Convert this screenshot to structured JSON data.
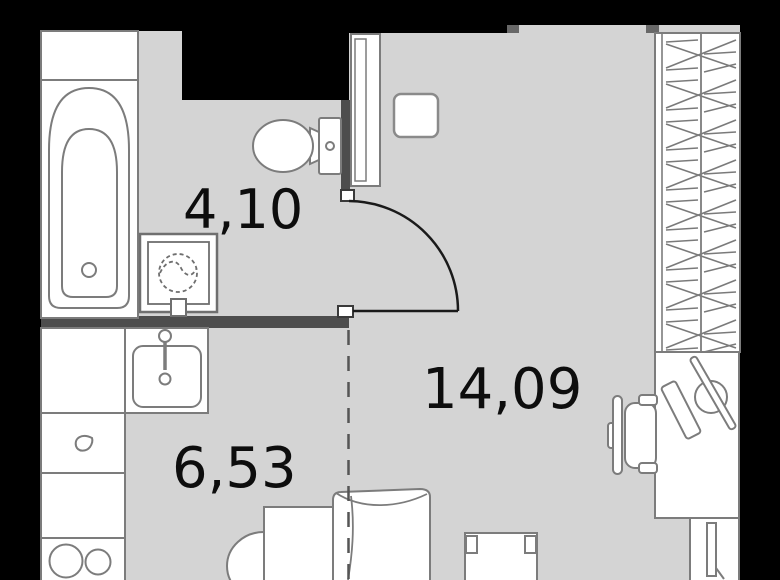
{
  "floor_plan": {
    "type": "studio-apartment-floor-plan",
    "labels": {
      "bathroom_area": "4,10",
      "kitchen_area": "6,53",
      "living_area": "14,09"
    },
    "rooms": [
      {
        "id": "bathroom",
        "area_sqm": "4,10"
      },
      {
        "id": "kitchen",
        "area_sqm": "6,53"
      },
      {
        "id": "living-room",
        "area_sqm": "14,09"
      }
    ],
    "furniture": [
      "bathtub",
      "washing-machine",
      "toilet",
      "hall-stool",
      "entry-door",
      "wardrobe",
      "desk",
      "desk-chair",
      "kitchen-counter",
      "kitchen-sink",
      "stove",
      "bed",
      "bed-table",
      "armchair",
      "tv-bench",
      "radiator"
    ],
    "colors": {
      "background_wall": "#000000",
      "floor": "#d4d4d4",
      "partition_wall": "#4d4d4d",
      "wall_stub": "#686868",
      "furniture_outline": "#7c7c7c",
      "furniture_fill": "#ffffff",
      "door_line": "#1a1a1a",
      "zoning_dash": "#555555",
      "label_text": "#0d0d0d"
    }
  }
}
